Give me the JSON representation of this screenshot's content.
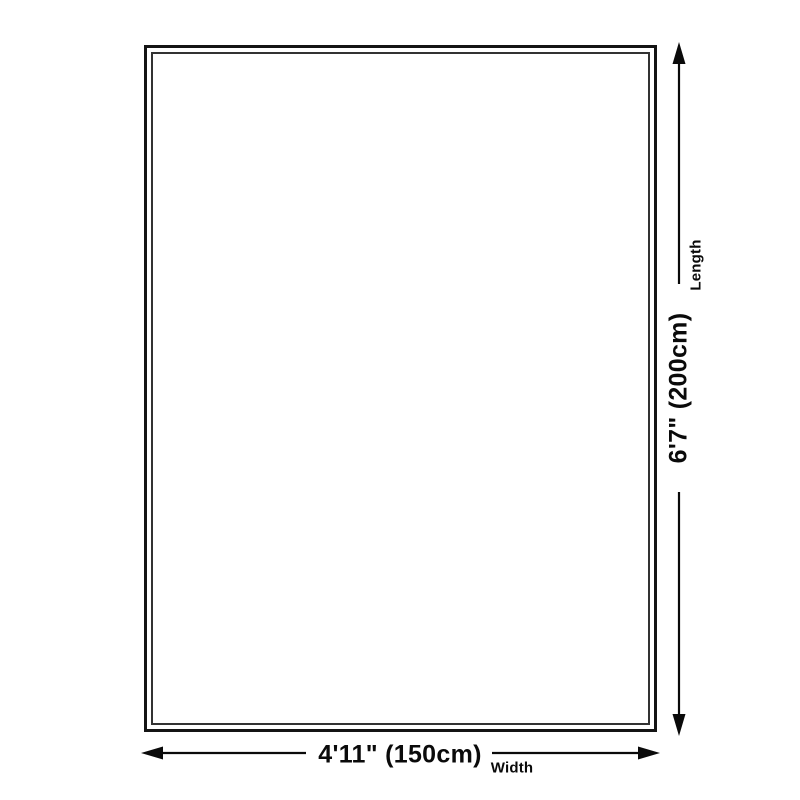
{
  "diagram": {
    "type": "product-size-diagram",
    "background": "#ffffff",
    "colors": {
      "arrow_line": "#0a0a0a",
      "outer_border": "#141414",
      "inner_border": "#333333",
      "text": "#0a0a0a"
    },
    "length": {
      "value": "6'7\" (200cm)",
      "label": "Length"
    },
    "width": {
      "value": "4'11\" (150cm)",
      "label": "Width"
    }
  }
}
